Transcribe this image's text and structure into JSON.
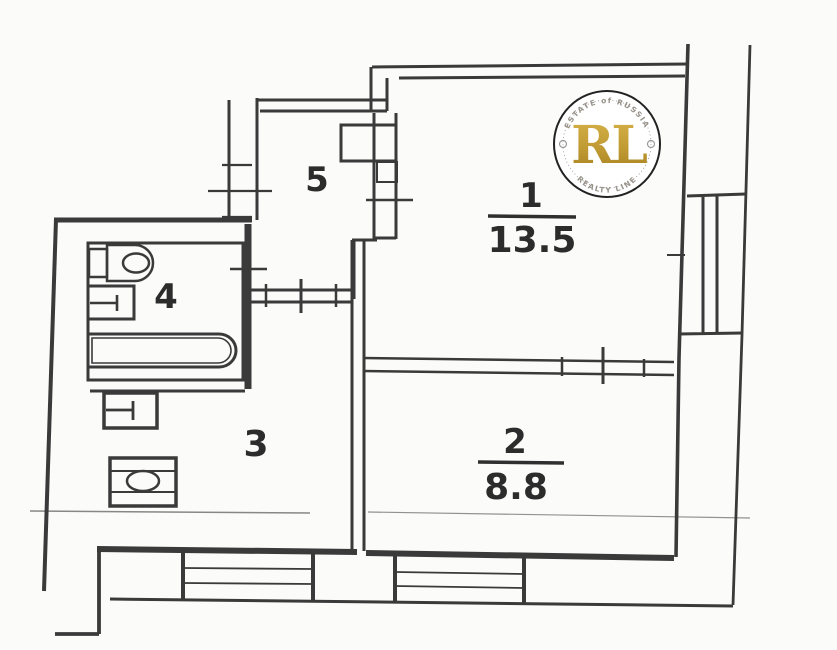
{
  "plan": {
    "rooms": [
      {
        "id": "room-1",
        "number": "1",
        "area": "13.5"
      },
      {
        "id": "room-2",
        "number": "2",
        "area": "8.8"
      },
      {
        "id": "room-3",
        "number": "3",
        "area": ""
      },
      {
        "id": "room-4",
        "number": "4",
        "area": ""
      },
      {
        "id": "room-5",
        "number": "5",
        "area": ""
      }
    ],
    "fixtures": [
      "toilet-icon",
      "bathtub-icon",
      "sink-icon",
      "washer-icon",
      "stove-icon"
    ],
    "ink_color": "#3a3a3a",
    "background_color": "#fbfbf9"
  },
  "logo": {
    "initials": "RL",
    "arc_top": "ESTATE of RUSSIA",
    "arc_bottom": "REALTY LINE",
    "gold_light": "#d7b44a",
    "gold_dark": "#a57e1e",
    "ring_color": "#222222"
  }
}
